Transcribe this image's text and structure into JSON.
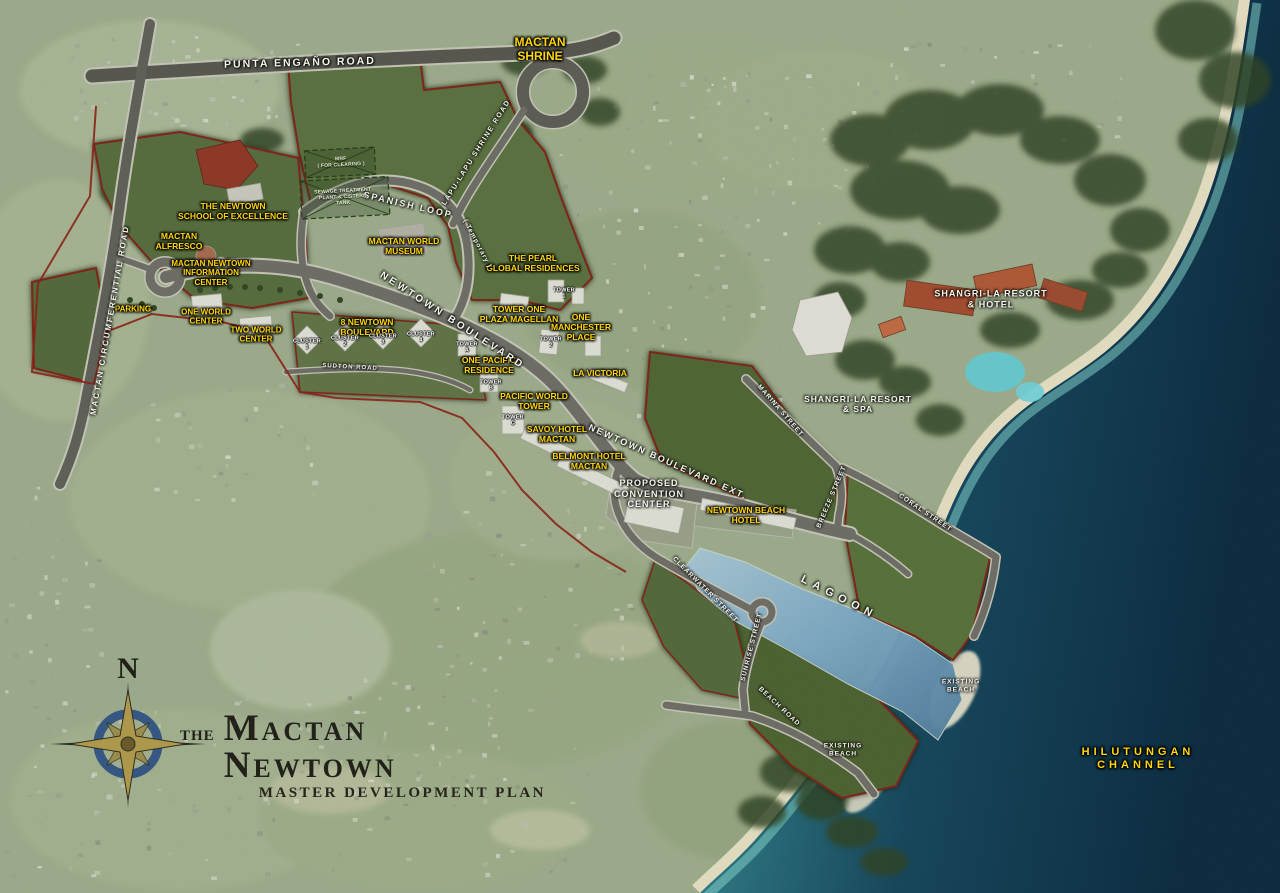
{
  "map": {
    "title": {
      "prefix": "the",
      "main": "Mactan Newtown",
      "subtitle": "MASTER DEVELOPMENT PLAN"
    },
    "compass": {
      "north": "N"
    },
    "roads": {
      "punta_engano": "PUNTA ENGAÑO ROAD",
      "circumferential": "MACTAN CIRCUMFERENTIAL ROAD",
      "lapu_lapu_shrine": "LAPU-LAPU SHRINE ROAD",
      "spanish_loop": "SPANISH LOOP",
      "spanish_loop_note": "( Temporary )",
      "newtown_blvd": "NEWTOWN BOULEVARD",
      "newtown_blvd_ext": "NEWTOWN BOULEVARD EXT.",
      "sudton": "SUDTON ROAD",
      "marina": "MARINA STREET",
      "breeze": "BREEZE STREET",
      "coral": "CORAL STREET",
      "clearwater": "CLEARWATER STREET",
      "sunrise": "SUNRISE STREET",
      "beach": "BEACH ROAD"
    },
    "places": {
      "shrine": "MACTAN\nSHRINE",
      "school": "THE NEWTOWN\nSCHOOL OF EXCELLENCE",
      "alfresco": "MACTAN\nALFRESCO",
      "info_center": "MACTAN NEWTOWN\nINFORMATION\nCENTER",
      "parking": "PARKING",
      "one_world": "ONE WORLD\nCENTER",
      "two_world": "TWO WORLD\nCENTER",
      "eight_newtown": "8 NEWTOWN\nBOULEVARD",
      "cluster_1": "CLUSTER\n1",
      "cluster_2": "CLUSTER\n2",
      "cluster_3": "CLUSTER\n3",
      "cluster_4": "CLUSTER\n4",
      "museum": "MACTAN WORLD\nMUSEUM",
      "pearl": "THE PEARL\nGLOBAL RESIDENCES",
      "tower_one_plaza": "TOWER ONE\nPLAZA MAGELLAN",
      "tower_1": "TOWER\n1",
      "tower_2": "TOWER\n2",
      "manchester": "ONE\nMANCHESTER\nPLACE",
      "one_pacific": "ONE PACIFIC\nRESIDENCE",
      "tower_a": "TOWER\nA",
      "tower_b": "TOWER\nB",
      "tower_c": "TOWER\nC",
      "la_victoria": "LA VICTORIA",
      "pacific_world": "PACIFIC WORLD\nTOWER",
      "savoy": "SAVOY HOTEL\nMACTAN",
      "belmont": "BELMONT HOTEL\nMACTAN",
      "convention": "PROPOSED\nCONVENTION\nCENTER",
      "beach_hotel": "NEWTOWN BEACH\nHOTEL",
      "mrf": "MRF\n( FOR CLEARING )",
      "sewage": "SEWAGE TREATMENT\nPLANT & CISTERN\nTANK"
    },
    "resort": {
      "hotel": "SHANGRI-LA  RESORT\n&  HOTEL",
      "spa": "SHANGRI-LA  RESORT\n&  SPA"
    },
    "water": {
      "lagoon": "LAGOON",
      "channel": "HILUTUNGAN\nCHANNEL",
      "existing_beach": "EXISTING\nBEACH"
    },
    "colors": {
      "label_yellow": "#FFD60A",
      "boundary_red": "#8A2015",
      "road_gray": "#6D6D66",
      "parcel_green": "#55673B",
      "sea_deep": "#0C2D44",
      "lagoon_blue": "#7BA8C4",
      "sand": "#E9E2C6"
    }
  }
}
